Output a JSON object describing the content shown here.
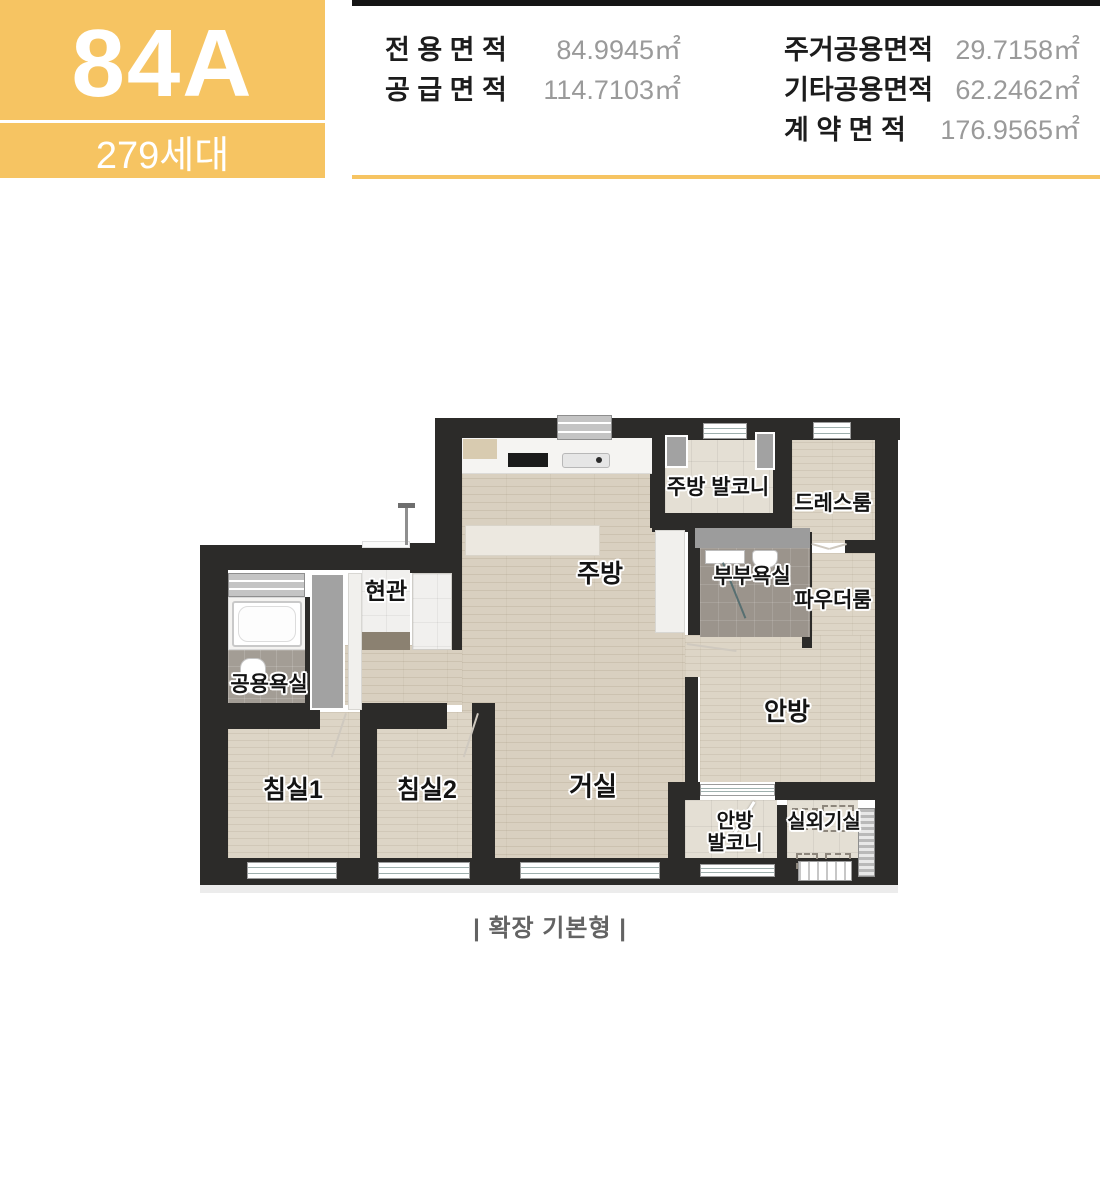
{
  "header": {
    "unit_type": "84A",
    "units_count": "279세대",
    "area_table": {
      "left": [
        {
          "label": "전 용 면 적",
          "value": "84.9945㎡"
        },
        {
          "label": "공 급 면 적",
          "value": "114.7103㎡"
        }
      ],
      "right": [
        {
          "label": "주거공용면적",
          "value": "29.7158㎡"
        },
        {
          "label": "기타공용면적",
          "value": "62.2462㎡"
        },
        {
          "label": "계 약 면 적",
          "value": "176.9565㎡"
        }
      ]
    }
  },
  "floorplan": {
    "rooms": {
      "kitchen_balcony": "주방 발코니",
      "dress_room": "드레스룸",
      "entrance": "현관",
      "kitchen": "주방",
      "master_bath": "부부욕실",
      "powder_room": "파우더룸",
      "common_bath": "공용욕실",
      "master_bedroom": "안방",
      "bedroom1": "침실1",
      "bedroom2": "침실2",
      "living_room": "거실",
      "master_balcony": "안방\n발코니",
      "outdoor_unit_room": "실외기실"
    },
    "caption": "| 확장 기본형 |"
  },
  "colors": {
    "accent": "#f6c462",
    "wall": "#2c2b29",
    "wood": "#d9d0c0",
    "bath_tile": "#9b948c",
    "value_gray": "#9a9a9a"
  }
}
